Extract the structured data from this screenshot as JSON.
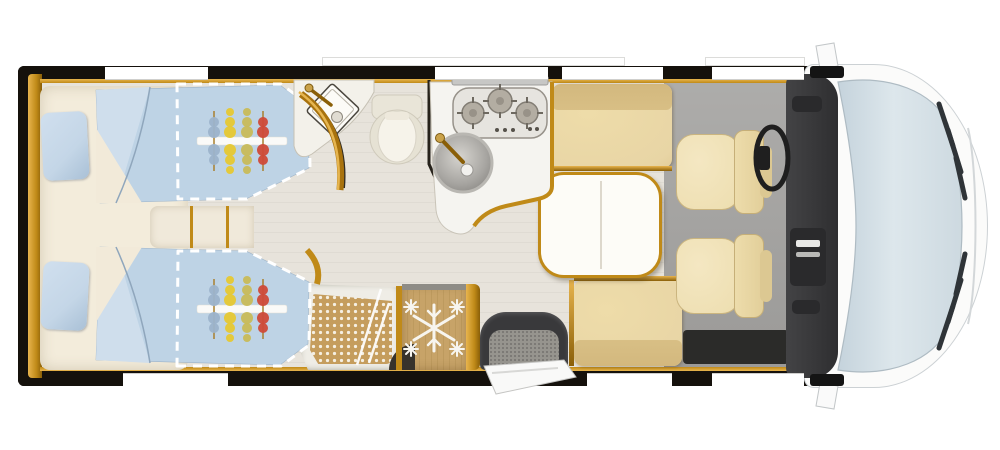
{
  "scene": {
    "description": "Top-down floor plan of an integrated motorhome with rear twin single beds, washroom, shower, kitchen, dinette and cab",
    "background": "#ffffff"
  },
  "palette": {
    "wall": "#15110c",
    "wood": "#c08a18",
    "wood_dark": "#8a5f08",
    "wood_light": "#e8b54e",
    "floor": "#e7e3db",
    "floor_line": "#dfdbd3",
    "cab_floor": "#9b9a98",
    "cream": "#f3ecdb",
    "duvet": "#bed3e5",
    "duvet_light": "#cfdeec",
    "pillow": "#c4d6e7",
    "bench": "#e8d5a5",
    "bench_dark": "#d8bf85",
    "chair": "#eedfb2",
    "chair_dark": "#e2cf9a",
    "table": "#fdfcf7",
    "counter": "#f5f4f0",
    "counter_edge": "#c9c4b8",
    "cooktop": "#e6e4df",
    "burner": "#b3ada2",
    "steel": "#c7c7c5",
    "fridge": "#c7a368",
    "mosaic": "#c59d5d",
    "mosaic_dot": "#f5efe2",
    "dash": "#39393b",
    "dash_dark": "#2a2a2c",
    "storage": "#2b2b29",
    "cab_body": "#fbfbfa",
    "windshield_a": "#dde7ec",
    "windshield_b": "#b9c9d3",
    "mat": "#96948e",
    "white": "#ffffff",
    "snow": "#f7f5ef",
    "motif_blue": "#9cb3cb",
    "motif_yellow": "#e6c832",
    "motif_olive": "#c8ba58",
    "motif_red": "#cf4a38",
    "motif_stem": "#a97f2e",
    "steering": "#1f1f1f",
    "headlight": "#2f3438"
  },
  "windows": {
    "top": [
      [
        105,
        103
      ],
      [
        435,
        113
      ],
      [
        562,
        101
      ],
      [
        712,
        92
      ]
    ],
    "bottom": [
      [
        123,
        105
      ],
      [
        587,
        85
      ],
      [
        712,
        92
      ]
    ]
  },
  "roof_strips": [
    [
      322,
      303
    ],
    [
      705,
      100
    ]
  ],
  "kitchen": {
    "burners": [
      [
        473,
        113,
        11
      ],
      [
        500,
        101,
        12
      ],
      [
        527,
        113,
        11
      ]
    ],
    "knob_dots": [
      [
        497,
        130
      ],
      [
        505,
        130
      ],
      [
        513,
        130
      ],
      [
        530,
        129
      ],
      [
        537,
        129
      ]
    ]
  },
  "cab": {
    "headlight_slashes": [
      [
        939,
        104,
        953,
        146
      ],
      [
        948,
        130,
        961,
        172
      ],
      [
        956,
        158,
        965,
        198
      ],
      [
        939,
        348,
        953,
        306
      ],
      [
        948,
        322,
        961,
        280
      ],
      [
        956,
        294,
        965,
        254
      ]
    ]
  },
  "bed_motif": {
    "centers": [
      [
        242,
        141
      ],
      [
        242,
        309
      ]
    ],
    "bar_half_width": 45,
    "columns": [
      {
        "x": 214,
        "color": "motif_blue",
        "petals": 2
      },
      {
        "x": 230,
        "color": "motif_yellow",
        "petals": 3
      },
      {
        "x": 247,
        "color": "motif_olive",
        "petals": 3
      },
      {
        "x": 263,
        "color": "motif_red",
        "petals": 2
      }
    ]
  },
  "features": [
    "twin-single-beds",
    "bed-extension-dashed-outline",
    "bed-pillows",
    "center-steps",
    "washroom-corner-sink",
    "toilet",
    "washroom-pivot-door",
    "shower-mosaic-floor",
    "refrigerator-freezer",
    "kitchen-cooktop-3-burner",
    "kitchen-round-sink",
    "dinette-table",
    "dinette-bench-front",
    "dinette-bench-rear",
    "driver-swivel-seat",
    "passenger-swivel-seat",
    "steering-wheel",
    "dashboard",
    "entry-door-with-step",
    "windshield",
    "hood",
    "headlights",
    "side-mirrors"
  ]
}
